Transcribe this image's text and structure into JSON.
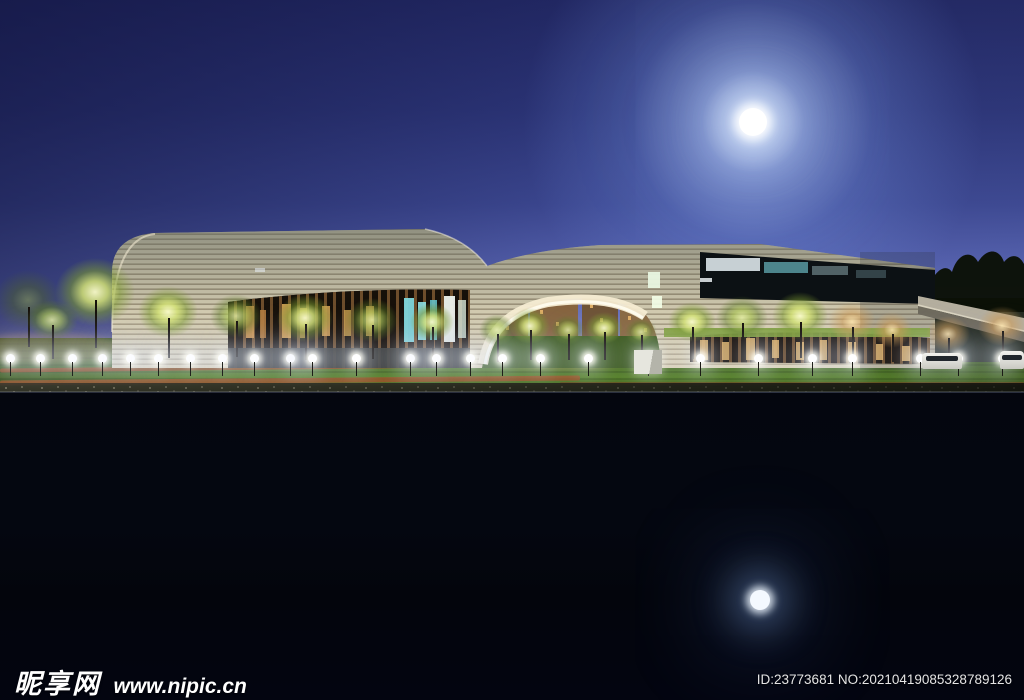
{
  "image": {
    "alt": "Night photograph of a modern ribbon-facade cultural building with a central arch, illuminated trees and sphere lamps on a lawn, perfectly mirrored in a still pond under a full moon"
  },
  "watermark": {
    "site_name": "昵享网",
    "site_url": "www.nipic.cn",
    "id_text": "ID:23773681 NO:20210419085328789126"
  },
  "scene": {
    "colors": {
      "sky_top": "#20245c",
      "sky_horizon": "#a9a1d2",
      "facade_cream": "#cfc8ae",
      "facade_groove": "#9a9078",
      "window_teal": "#7fd8dc",
      "window_warm": "#d8a558",
      "lawn_green": "#4f7a20",
      "water_dark": "#04060e",
      "moon_white": "#ffffff"
    },
    "moon": {
      "x": 753,
      "y": 122,
      "r": 14
    },
    "moon_reflection": {
      "x": 760,
      "y": 600,
      "r": 10
    },
    "trees": [
      {
        "x": 28,
        "cy": 300,
        "rx": 34,
        "ry": 30,
        "tone": "dim",
        "trunk": 40
      },
      {
        "x": 95,
        "cy": 292,
        "rx": 40,
        "ry": 34,
        "tone": "lit",
        "trunk": 48
      },
      {
        "x": 52,
        "cy": 320,
        "rx": 26,
        "ry": 20,
        "tone": "lit2",
        "trunk": 34
      },
      {
        "x": 168,
        "cy": 312,
        "rx": 30,
        "ry": 26,
        "tone": "lit",
        "trunk": 40
      },
      {
        "x": 236,
        "cy": 316,
        "rx": 26,
        "ry": 22,
        "tone": "lit2",
        "trunk": 36
      },
      {
        "x": 305,
        "cy": 318,
        "rx": 28,
        "ry": 24,
        "tone": "lit",
        "trunk": 36
      },
      {
        "x": 372,
        "cy": 320,
        "rx": 26,
        "ry": 22,
        "tone": "lit2",
        "trunk": 34
      },
      {
        "x": 432,
        "cy": 322,
        "rx": 22,
        "ry": 19,
        "tone": "lit",
        "trunk": 32
      },
      {
        "x": 497,
        "cy": 330,
        "rx": 18,
        "ry": 16,
        "tone": "lit2",
        "trunk": 28
      },
      {
        "x": 530,
        "cy": 326,
        "rx": 20,
        "ry": 18,
        "tone": "lit",
        "trunk": 30
      },
      {
        "x": 568,
        "cy": 330,
        "rx": 17,
        "ry": 15,
        "tone": "lit2",
        "trunk": 26
      },
      {
        "x": 604,
        "cy": 328,
        "rx": 19,
        "ry": 16,
        "tone": "lit",
        "trunk": 28
      },
      {
        "x": 641,
        "cy": 332,
        "rx": 16,
        "ry": 14,
        "tone": "lit2",
        "trunk": 24
      },
      {
        "x": 692,
        "cy": 322,
        "rx": 24,
        "ry": 20,
        "tone": "lit",
        "trunk": 32
      },
      {
        "x": 742,
        "cy": 318,
        "rx": 26,
        "ry": 22,
        "tone": "lit2",
        "trunk": 34
      },
      {
        "x": 800,
        "cy": 316,
        "rx": 28,
        "ry": 24,
        "tone": "lit",
        "trunk": 36
      },
      {
        "x": 852,
        "cy": 322,
        "rx": 24,
        "ry": 20,
        "tone": "warm",
        "trunk": 34
      },
      {
        "x": 892,
        "cy": 330,
        "rx": 20,
        "ry": 18,
        "tone": "warm",
        "trunk": 28
      },
      {
        "x": 948,
        "cy": 334,
        "rx": 22,
        "ry": 18,
        "tone": "warm",
        "trunk": 26
      },
      {
        "x": 1002,
        "cy": 326,
        "rx": 24,
        "ry": 20,
        "tone": "warm",
        "trunk": 30
      }
    ],
    "lamps": {
      "base_y": 358,
      "xs": [
        10,
        40,
        72,
        102,
        130,
        158,
        190,
        222,
        254,
        290,
        312,
        356,
        410,
        436,
        470,
        502,
        540,
        588,
        648,
        700,
        758,
        812,
        852,
        920,
        958,
        1002
      ]
    }
  }
}
